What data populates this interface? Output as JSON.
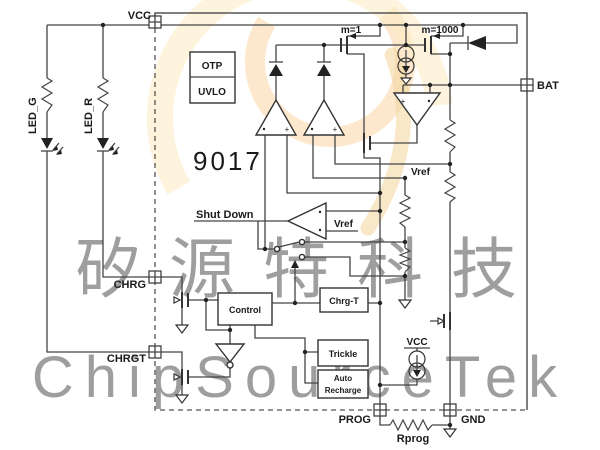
{
  "part_number": "9017",
  "pins": {
    "vcc": "VCC",
    "bat": "BAT",
    "chrg": "CHRG",
    "chrgt": "CHRGT",
    "prog": "PROG",
    "gnd": "GND"
  },
  "blocks": {
    "otp": "OTP",
    "uvlo": "UVLO",
    "control": "Control",
    "chrg_t": "Chrg-T",
    "trickle": "Trickle",
    "auto_line1": "Auto",
    "auto_line2": "Recharge"
  },
  "labels": {
    "m1": "m=1",
    "m1000": "m=1000",
    "vref_top": "Vref",
    "vref_sd": "Vref",
    "shut_down": "Shut Down",
    "vcc_internal": "VCC",
    "rprog": "Rprog",
    "led_g": "LED_G",
    "led_r": "LED_R"
  },
  "watermark": {
    "cjk": "矽源特科技",
    "latin": "ChipSourceTek"
  },
  "colors": {
    "wire": "#444444",
    "boundary": "#555555",
    "part_number": "#76899c",
    "logo_orange": "#f39d38",
    "logo_yellow": "#fbd98e",
    "logo_gold": "#e3aa38",
    "watermark_text": "#aaaaaa"
  }
}
